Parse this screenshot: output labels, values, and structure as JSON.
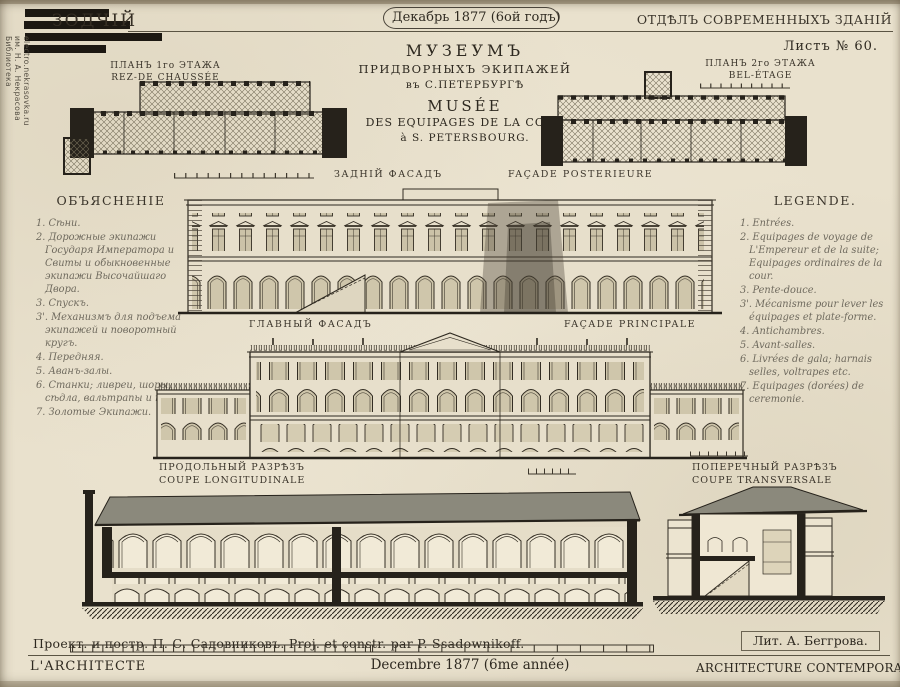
{
  "colors": {
    "paper": "#e9e1cd",
    "ink": "#2e2920",
    "roof_gray": "#8b897c",
    "stamp_black": "#1c1812",
    "script_ink": "#6f6a5e"
  },
  "header": {
    "masthead": "ЗОДЧІЙ",
    "date_box": "Декабрь 1877 (6ой годъ)",
    "section_title": "ОТДѢЛЪ СОВРЕМЕННЫХЪ ЗДАНІЙ",
    "sheet_no": "Листъ № 60."
  },
  "library_stamp": {
    "line1": "Библиотека",
    "line2": "им. Н. А. Некрасова",
    "line3": "electro.nekrasovka.ru"
  },
  "title_block": {
    "ru_line1": "МУЗЕУМЪ",
    "ru_line2": "ПРИДВОРНЫХЪ ЭКИПАЖЕЙ",
    "ru_line3": "въ С.ПЕТЕРБУРГѢ",
    "fr_line1": "MUSÉE",
    "fr_line2": "DES EQUIPAGES DE LA COUR",
    "fr_line3": "à S. PETERSBOURG."
  },
  "plan_left": {
    "label_ru": "ПЛАНЪ 1го ЭТАЖА",
    "label_fr": "REZ-DE CHAUSSÉE"
  },
  "plan_right": {
    "label_ru": "ПЛАНЪ 2го ЭТАЖА",
    "label_fr": "BEL-ÉTAGE"
  },
  "back_facade": {
    "label_ru": "ЗАДНІЙ ФАСАДЪ",
    "label_fr": "FAÇADE POSTERIEURE"
  },
  "main_facade": {
    "label_ru": "ГЛАВНЫЙ ФАСАДЪ",
    "label_fr": "FAÇADE PRINCIPALE"
  },
  "long_section": {
    "label_ru": "ПРОДОЛЬНЫЙ РАЗРѢЗЪ",
    "label_fr": "COUPE LONGITUDINALE"
  },
  "cross_section": {
    "label_ru": "ПОПЕРЕЧНЫЙ РАЗРѢЗЪ",
    "label_fr": "COUPE TRANSVERSALE"
  },
  "legend_ru": {
    "title": "ОБЪЯСНЕНІЕ",
    "items": [
      "1. Сѣни.",
      "2. Дорожные экипажи Государя Императора и Свиты и обыкновенные экипажи Высочайшаго Двора.",
      "3. Спускъ.",
      "3'. Механизмъ для подъема экипажей и поворотный кругъ.",
      "4. Передняя.",
      "5. Аванъ-залы.",
      "6. Станки; ливреи, шоры, сѣдла, вальтрапы и проч.",
      "7. Золотые Экипажи."
    ]
  },
  "legend_fr": {
    "title": "LEGENDE.",
    "items": [
      "1. Entrées.",
      "2. Equipages de voyage de L'Empereur et de la suite; Equipages ordinaires de la cour.",
      "3. Pente-douce.",
      "3'. Mécanisme pour lever les équipages et plate-forme.",
      "4. Antichambres.",
      "5. Avant-salles.",
      "6. Livrées de gala; harnais selles, voltrapes etc.",
      "7. Equipages (dorées) de ceremonie."
    ]
  },
  "credits": {
    "designer": "Проект. и постр. П. С. Садовниковъ. Proj. et constr. par P. Ssadownikoff.",
    "lithographer": "Лит. А. Беггрова."
  },
  "footer": {
    "left": "L'ARCHITECTE",
    "center": "Decembre 1877 (6me année)",
    "right": "ARCHITECTURE CONTEMPORAINE"
  }
}
